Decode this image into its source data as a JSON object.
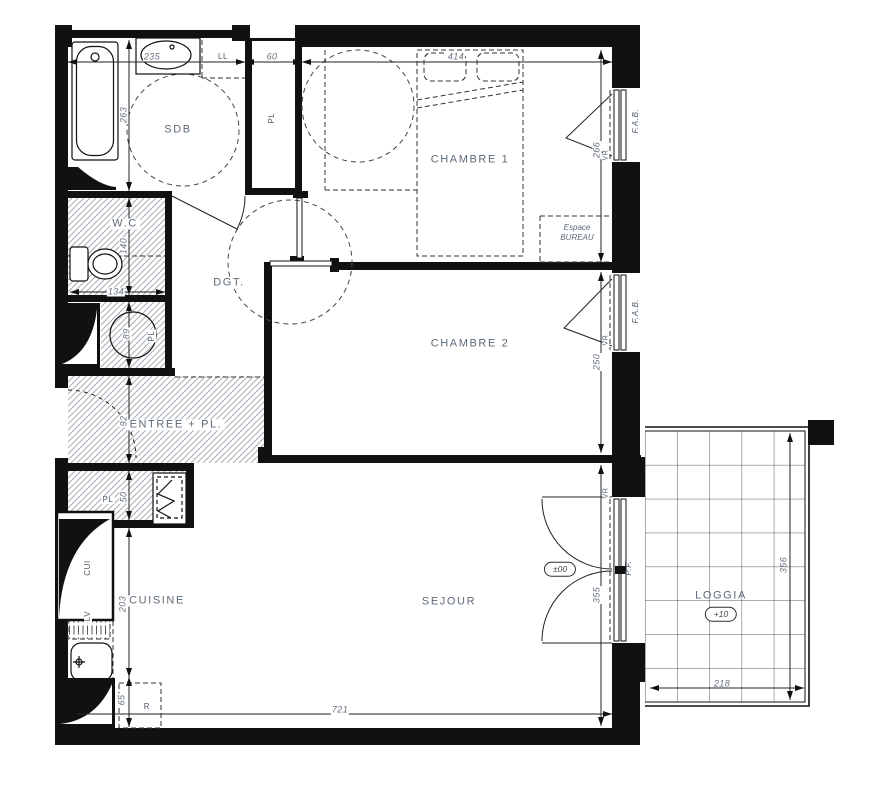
{
  "labels": {
    "sdb": "SDB",
    "wc": "W.C",
    "dgt": "DGT.",
    "chambre1": "CHAMBRE 1",
    "chambre2": "CHAMBRE 2",
    "entree": "ENTREE + PL.",
    "cuisine": "CUISINE",
    "sejour": "SEJOUR",
    "loggia": "LOGGIA",
    "espace_line1": "Espace",
    "espace_line2": "BUREAU",
    "pl": "PL",
    "ll": "LL",
    "cui": "CUI",
    "lv": "LV",
    "r": "R",
    "fab": "F.A.B.",
    "vr": "VR",
    "pf": "P.F.",
    "level_sejour": "±00",
    "level_loggia": "+10"
  },
  "dims": {
    "w_sdb": "235",
    "w_pl": "60",
    "w_ch1": "414",
    "h_sdb": "263",
    "h_wc": "140",
    "w_wc": "134",
    "h_ballon": "89",
    "h_ch1": "266",
    "h_ch2": "250",
    "h_entree": "92",
    "h_pl": "50",
    "h_cuisine": "203",
    "h_r": "65",
    "h_sejour": "355",
    "w_total": "721",
    "h_loggia": "356",
    "w_loggia": "218"
  },
  "colors": {
    "wall": "#111111",
    "label": "#5c6b7a",
    "dim_text": "#66717f",
    "hatch": "#a8adb5"
  }
}
